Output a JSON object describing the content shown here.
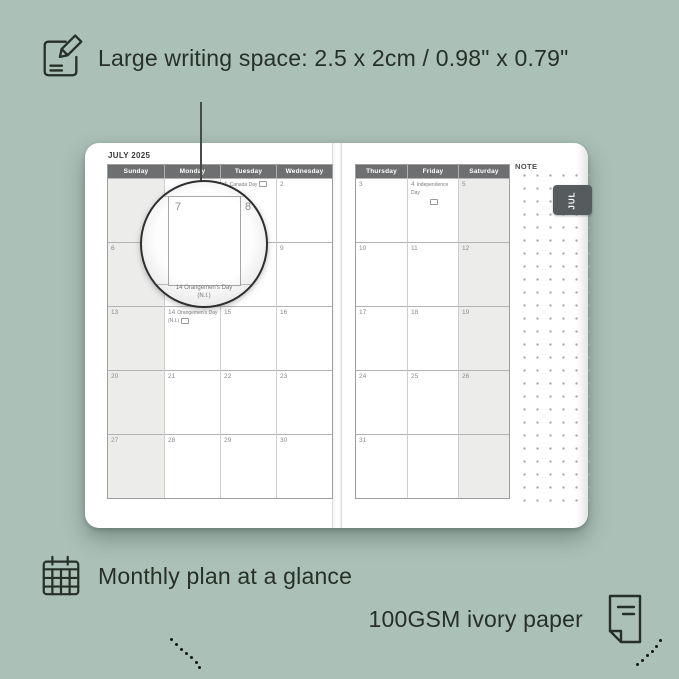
{
  "colors": {
    "background": "#abc0b7",
    "ink": "#263029",
    "header_bg": "#6d6f71",
    "header_text": "#ffffff",
    "shaded_cell": "#ececeb",
    "tab_bg": "#565b5d",
    "page_bg": "#ffffff"
  },
  "top_caption": {
    "icon": "pencil-note-icon",
    "text": "Large writing space: 2.5 x 2cm / 0.98\" x 0.79\""
  },
  "planner": {
    "month_title": "JULY 2025",
    "tab_label": "JUL",
    "note_label": "NOTE",
    "left_page": {
      "shaded_col": 0,
      "day_headers": [
        "Sunday",
        "Monday",
        "Tuesday",
        "Wednesday"
      ],
      "rows": [
        [
          {
            "day": ""
          },
          {
            "day": ""
          },
          {
            "day": "1",
            "holiday": "Canada Day",
            "flag": true
          },
          {
            "day": "2"
          }
        ],
        [
          {
            "day": "6"
          },
          {
            "day": "7"
          },
          {
            "day": "8"
          },
          {
            "day": "9"
          }
        ],
        [
          {
            "day": "13"
          },
          {
            "day": "14",
            "holiday": "Orangemen's Day (N.I.)",
            "flag": true
          },
          {
            "day": "15"
          },
          {
            "day": "16"
          }
        ],
        [
          {
            "day": "20"
          },
          {
            "day": "21"
          },
          {
            "day": "22"
          },
          {
            "day": "23"
          }
        ],
        [
          {
            "day": "27"
          },
          {
            "day": "28"
          },
          {
            "day": "29"
          },
          {
            "day": "30"
          }
        ]
      ]
    },
    "right_page": {
      "shaded_col": 2,
      "day_headers": [
        "Thursday",
        "Friday",
        "Saturday"
      ],
      "rows": [
        [
          {
            "day": "3"
          },
          {
            "day": "4",
            "holiday": "Independence Day",
            "flag": true,
            "flag_below": true
          },
          {
            "day": "5"
          }
        ],
        [
          {
            "day": "10"
          },
          {
            "day": "11"
          },
          {
            "day": "12"
          }
        ],
        [
          {
            "day": "17"
          },
          {
            "day": "18"
          },
          {
            "day": "19"
          }
        ],
        [
          {
            "day": "24"
          },
          {
            "day": "25"
          },
          {
            "day": "26"
          }
        ],
        [
          {
            "day": "31"
          },
          {
            "day": ""
          },
          {
            "day": ""
          }
        ]
      ]
    },
    "magnifier": {
      "day_left": "7",
      "day_right": "8",
      "caption_line1": "14  Orangemen's Day",
      "caption_line2": "(N.I.)"
    }
  },
  "bottom_captions": {
    "monthly": {
      "icon": "calendar-grid-icon",
      "text": "Monthly plan at a glance"
    },
    "paper": {
      "icon": "paper-sheet-icon",
      "text": "100GSM ivory paper"
    }
  }
}
